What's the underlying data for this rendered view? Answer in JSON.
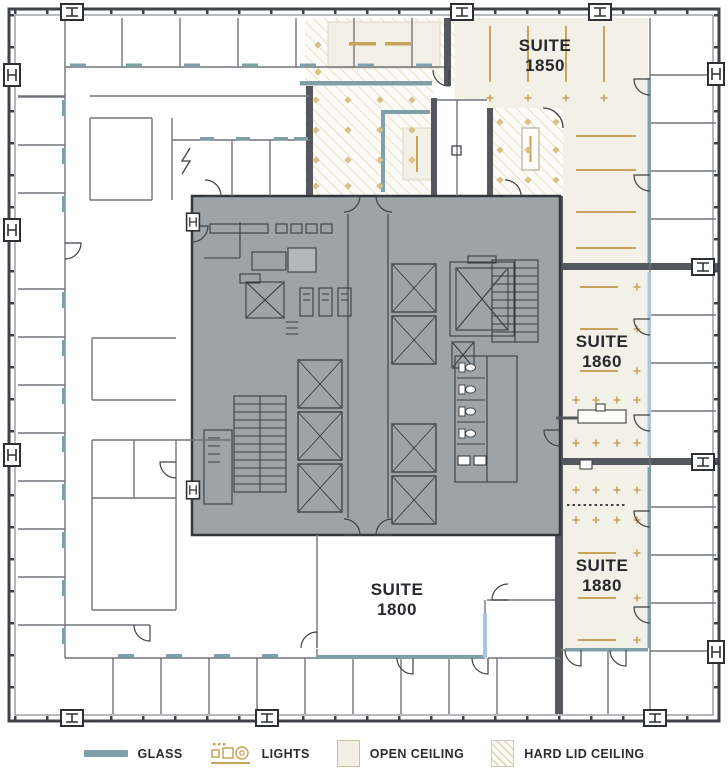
{
  "suites": [
    {
      "line1": "SUITE",
      "line2": "1850"
    },
    {
      "line1": "SUITE",
      "line2": "1860"
    },
    {
      "line1": "SUITE",
      "line2": "1880"
    },
    {
      "line1": "SUITE",
      "line2": "1800"
    }
  ],
  "legend": {
    "items": [
      {
        "label": "GLASS",
        "swatch": "glass-line"
      },
      {
        "label": "LIGHTS",
        "swatch": "lights-icon"
      },
      {
        "label": "OPEN CEILING",
        "swatch": "open-ceiling-square"
      },
      {
        "label": "HARD LID CEILING",
        "swatch": "hatched-square"
      }
    ]
  },
  "colors": {
    "glass": "#7FA0A8",
    "glass_light": "#A8C6E3",
    "gold": "#C8A35B",
    "open_ceiling": "#F3F0E7",
    "hatch_line": "#E2DABC",
    "core_gray": "#9EA3A8",
    "wall_dark": "#3F4347",
    "demising_wall": "#54585D",
    "label_text": "#26282C"
  }
}
